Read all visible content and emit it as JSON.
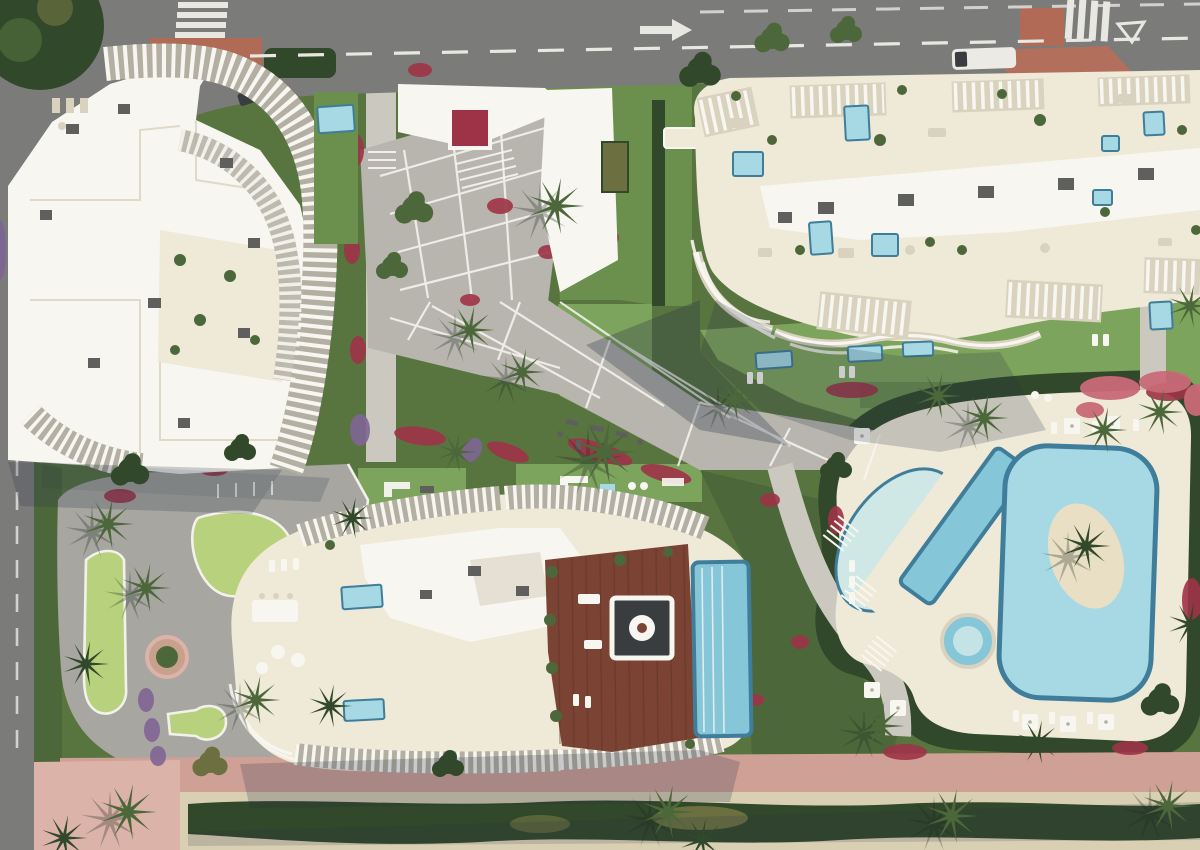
{
  "palette": {
    "asphalt": "#7b7b79",
    "asphalt_light": "#8f8f8c",
    "road_marking": "#e8e7e2",
    "terracotta": "#b06a55",
    "island_red": "#b2705c",
    "lawn": "#6b8f4d",
    "lawn_dark": "#587540",
    "lawn_light": "#7da45c",
    "putting_green": "#b9d47c",
    "veg_dark": "#31482a",
    "veg_mid": "#4c683a",
    "veg_olive": "#6c7040",
    "flower_red": "#9e3347",
    "flower_pink": "#c96a78",
    "flower_purple": "#7f6596",
    "paving": "#b8b5ae",
    "paving_light": "#cbc8c0",
    "plaza_gray": "#a7a6a0",
    "white": "#f8f6f0",
    "cream": "#efe9d8",
    "cream_shadow": "#d9d2bf",
    "louver_gap": "#b3afa3",
    "ac_gray": "#5f5f5d",
    "wood": "#7a4334",
    "wood_line": "#5e3226",
    "pool_aqua": "#a6d9e3",
    "pool_mid": "#85c6d8",
    "pool_deep": "#3f7d9b",
    "pool_pale": "#cfe8e6",
    "sand_island": "#e9dfc4",
    "pink_path": "#cfa096",
    "pink_light": "#dcb3a9",
    "sand": "#d9cfb3",
    "shadow": "#2a3348",
    "ground_shadow": "#1f2a22",
    "vehicle": "#eceae4",
    "car_dark": "#3a3d40"
  }
}
